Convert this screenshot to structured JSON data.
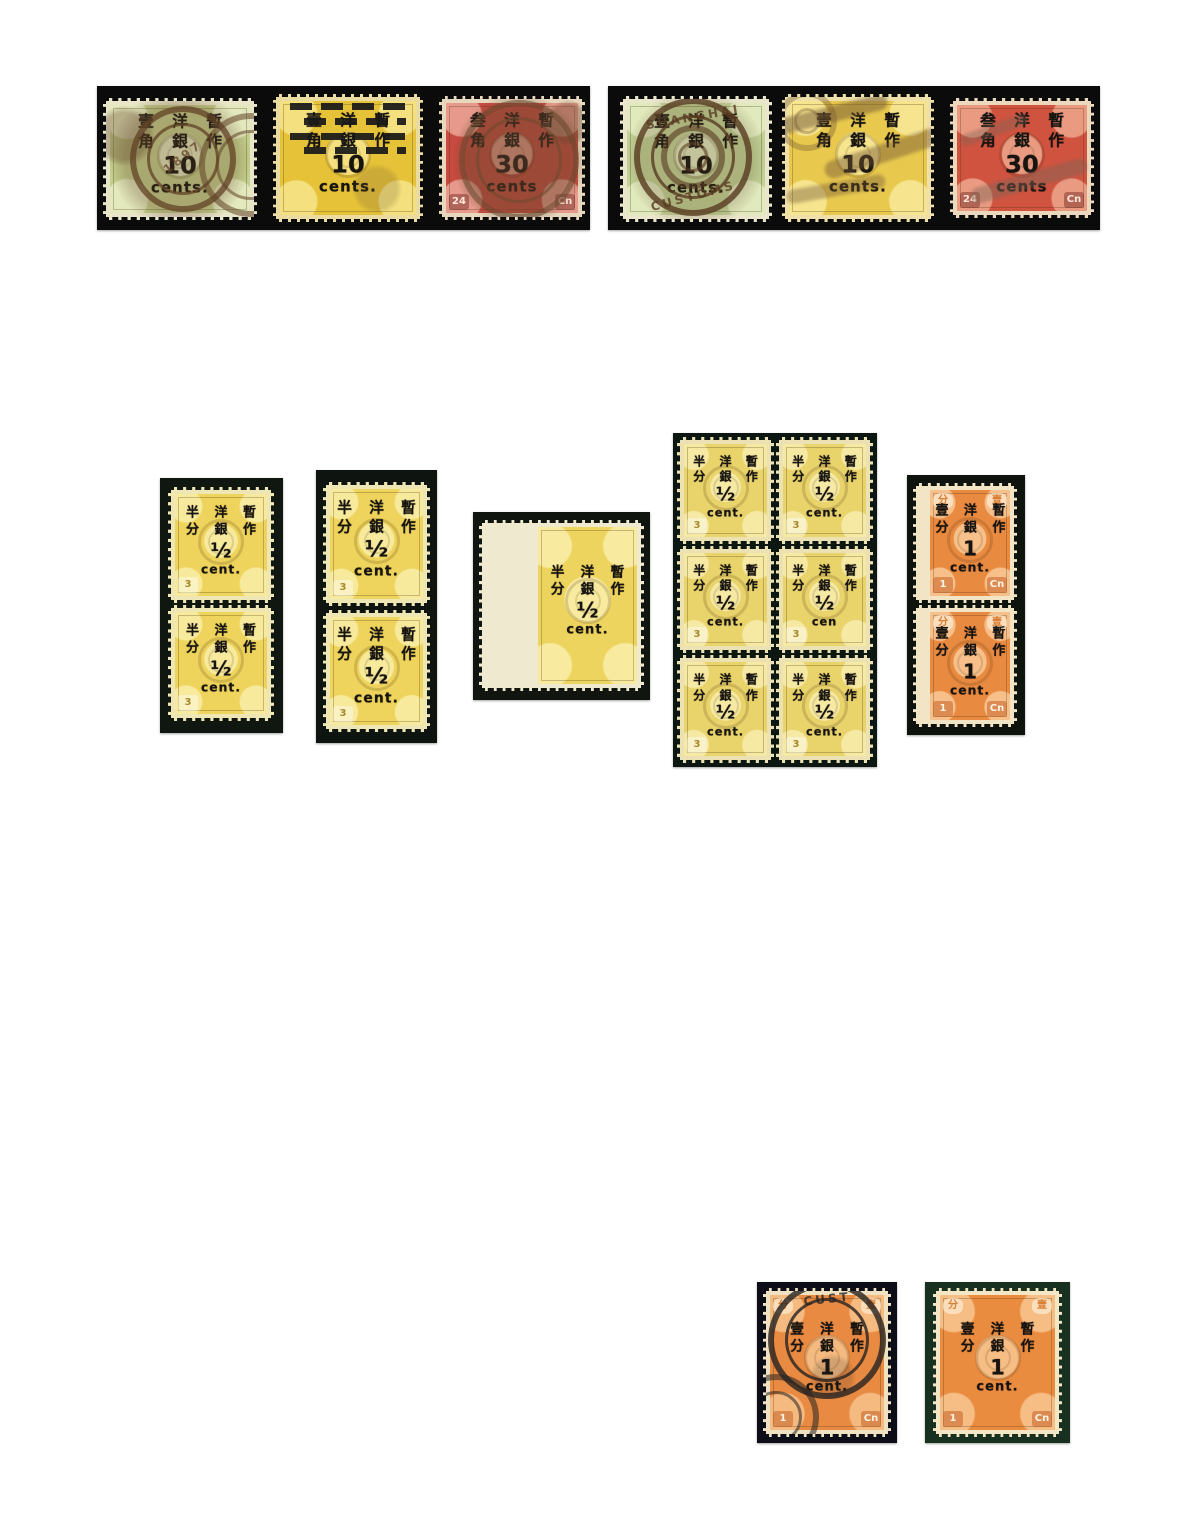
{
  "page": {
    "bg": "#ffffff",
    "width": 1194,
    "height": 1539
  },
  "stamp_groups": [
    {
      "name": "strip-left",
      "x": 97,
      "y": 86,
      "w": 493,
      "h": 144,
      "mat": "#0b0b0b",
      "stamps": [
        {
          "x": 6,
          "y": 12,
          "w": 154,
          "h": 122,
          "base": "#c3cf8c",
          "light": "#e3e9bd",
          "paper": "#e9e5c9",
          "op_scale": 1.2,
          "overprint": {
            "row1": "壹 洋 暫",
            "row2": "角 銀 作",
            "value": "10",
            "unit": "cents."
          },
          "cancels": [
            {
              "kind": "blob",
              "cx": 50,
              "cy": 50,
              "d": 140,
              "color": "rgba(97,66,38,0.28)"
            },
            {
              "kind": "ring",
              "cx": 52,
              "cy": 50,
              "d": 106,
              "color": "rgba(97,66,38,0.75)",
              "text": "1897",
              "rot": -38,
              "ty": "40%"
            },
            {
              "kind": "ring",
              "cx": 98,
              "cy": 55,
              "d": 104,
              "color": "rgba(97,66,38,0.55)"
            },
            {
              "kind": "blob",
              "cx": 12,
              "cy": 30,
              "d": 60,
              "color": "rgba(97,66,38,0.35)"
            }
          ]
        },
        {
          "x": 176,
          "y": 8,
          "w": 150,
          "h": 128,
          "base": "#e5c238",
          "light": "#f4e07e",
          "paper": "#eadca0",
          "op_scale": 1.2,
          "overprint": {
            "row1": "壹 洋 暫",
            "row2": "角 銀 作",
            "value": "10",
            "unit": "cents."
          },
          "cancels": [
            {
              "kind": "bars",
              "x": 10,
              "y": 5,
              "w": 80,
              "h": 42,
              "color": "rgba(24,24,24,0.92)"
            },
            {
              "kind": "blob",
              "cx": 70,
              "cy": 75,
              "d": 50,
              "color": "rgba(110,85,50,0.22)"
            }
          ]
        },
        {
          "x": 342,
          "y": 10,
          "w": 146,
          "h": 124,
          "base": "#c94a41",
          "light": "#e79a8b",
          "paper": "#e7d8bd",
          "op_scale": 1.2,
          "corners": {
            "bl": "24",
            "br": "Cn"
          },
          "badge": {
            "fg": "#ffe9da",
            "bg": "rgba(90,15,12,0.38)"
          },
          "overprint": {
            "row1": "叁 洋 暫",
            "row2": "角 銀 作",
            "value": "30",
            "unit": "cents"
          },
          "cancels": [
            {
              "kind": "blob",
              "cx": 55,
              "cy": 52,
              "d": 132,
              "color": "rgba(104,72,46,0.45)"
            },
            {
              "kind": "ring",
              "cx": 55,
              "cy": 52,
              "d": 120,
              "color": "rgba(104,72,46,0.55)"
            },
            {
              "kind": "blob",
              "cx": 90,
              "cy": 20,
              "d": 46,
              "color": "rgba(104,72,46,0.4)"
            }
          ]
        }
      ]
    },
    {
      "name": "strip-right",
      "x": 608,
      "y": 86,
      "w": 492,
      "h": 144,
      "mat": "#0b0b0b",
      "stamps": [
        {
          "x": 12,
          "y": 10,
          "w": 152,
          "h": 126,
          "base": "#c2d396",
          "light": "#e1eabd",
          "paper": "#e9e6cb",
          "op_scale": 1.2,
          "overprint": {
            "row1": "壹 洋 暫",
            "row2": "角 銀 作",
            "value": "10",
            "unit": "cents."
          },
          "cancels": [
            {
              "kind": "blob",
              "cx": 50,
              "cy": 50,
              "d": 140,
              "color": "rgba(88,59,33,0.22)"
            },
            {
              "kind": "ring",
              "cx": 48,
              "cy": 48,
              "d": 118,
              "color": "rgba(88,59,33,0.8)",
              "text": "SHANGHAI",
              "rot": -10,
              "ty": "6%",
              "text2": "CUSTOMS",
              "rot2": -15
            },
            {
              "kind": "ring",
              "cx": 48,
              "cy": 48,
              "d": 64,
              "color": "rgba(88,59,33,0.6)"
            }
          ]
        },
        {
          "x": 174,
          "y": 8,
          "w": 152,
          "h": 128,
          "base": "#e8c94e",
          "light": "#f6e48e",
          "paper": "#eee0a8",
          "op_scale": 1.2,
          "overprint": {
            "row1": "壹 洋 暫",
            "row2": "角 銀 作",
            "value": "10",
            "unit": "cents."
          },
          "cancels": [
            {
              "kind": "streak",
              "cx": 30,
              "cy": 15,
              "w": 120,
              "h": 16,
              "rot": -14,
              "color": "rgba(112,84,52,0.5)"
            },
            {
              "kind": "streak",
              "cx": 70,
              "cy": 45,
              "w": 130,
              "h": 18,
              "rot": -18,
              "color": "rgba(112,84,52,0.45)"
            },
            {
              "kind": "streak",
              "cx": 35,
              "cy": 75,
              "w": 100,
              "h": 14,
              "rot": -10,
              "color": "rgba(112,84,52,0.4)"
            },
            {
              "kind": "ring",
              "cx": 15,
              "cy": 20,
              "d": 60,
              "color": "rgba(112,84,52,0.35)"
            }
          ]
        },
        {
          "x": 342,
          "y": 12,
          "w": 144,
          "h": 120,
          "base": "#d05340",
          "light": "#eb9a82",
          "paper": "#ecd8bc",
          "op_scale": 1.2,
          "corners": {
            "bl": "24",
            "br": "Cn"
          },
          "badge": {
            "fg": "#ffe9da",
            "bg": "rgba(90,15,12,0.38)"
          },
          "overprint": {
            "row1": "叁 洋 暫",
            "row2": "角 銀 作",
            "value": "30",
            "unit": "cents"
          },
          "cancels": [
            {
              "kind": "streak",
              "cx": 55,
              "cy": 70,
              "w": 120,
              "h": 16,
              "rot": -16,
              "color": "rgba(125,100,85,0.45)"
            },
            {
              "kind": "streak",
              "cx": 30,
              "cy": 25,
              "w": 70,
              "h": 12,
              "rot": -20,
              "color": "rgba(125,100,85,0.4)"
            }
          ]
        }
      ]
    },
    {
      "name": "pair-yellow-left",
      "x": 160,
      "y": 478,
      "w": 123,
      "h": 255,
      "mat": "#101711",
      "stamps": [
        {
          "x": 8,
          "y": 9,
          "w": 106,
          "h": 116,
          "base": "#eed45c",
          "light": "#f8ea9d",
          "paper": "#efe6b6",
          "op_scale": 1.0,
          "corners": {
            "bl": "3"
          },
          "badge": {
            "fg": "#a8882a",
            "bg": "rgba(255,255,255,0.4)"
          },
          "overprint": {
            "row1": "半 洋 暫",
            "row2": "分 銀 作",
            "value": "½",
            "unit": "cent."
          }
        },
        {
          "x": 8,
          "y": 127,
          "w": 106,
          "h": 116,
          "base": "#eed45c",
          "light": "#f8ea9d",
          "paper": "#efe6b6",
          "op_scale": 1.0,
          "corners": {
            "bl": "3"
          },
          "badge": {
            "fg": "#a8882a",
            "bg": "rgba(255,255,255,0.4)"
          },
          "overprint": {
            "row1": "半 洋 暫",
            "row2": "分 銀 作",
            "value": "½",
            "unit": "cent."
          }
        }
      ]
    },
    {
      "name": "pair-yellow-mid",
      "x": 316,
      "y": 470,
      "w": 121,
      "h": 273,
      "mat": "#0e1511",
      "stamps": [
        {
          "x": 7,
          "y": 12,
          "w": 107,
          "h": 124,
          "base": "#eed45c",
          "light": "#f8ea9d",
          "paper": "#efe6b6",
          "op_scale": 1.12,
          "corners": {
            "bl": "3"
          },
          "badge": {
            "fg": "#a8882a",
            "bg": "rgba(255,255,255,0.4)"
          },
          "overprint": {
            "row1": "半 洋 暫",
            "row2": "分 銀 作",
            "value": "½",
            "unit": "cent."
          }
        },
        {
          "x": 7,
          "y": 140,
          "w": 107,
          "h": 122,
          "base": "#eed45c",
          "light": "#f8ea9d",
          "paper": "#efe6b6",
          "op_scale": 1.12,
          "corners": {
            "bl": "3"
          },
          "badge": {
            "fg": "#a8882a",
            "bg": "rgba(255,255,255,0.4)"
          },
          "overprint": {
            "row1": "半 洋 暫",
            "row2": "分 銀 作",
            "value": "½",
            "unit": "cent."
          }
        }
      ]
    },
    {
      "name": "single-yellow-margin",
      "x": 473,
      "y": 512,
      "w": 177,
      "h": 188,
      "mat": "#10160f",
      "stamps": [
        {
          "x": 6,
          "y": 8,
          "w": 165,
          "h": 171,
          "ml": 56,
          "base": "#edd45f",
          "light": "#f8eb9f",
          "paper": "#efe9cf",
          "op_scale": 1.05,
          "overprint": {
            "row1": "半 洋 暫",
            "row2": "分 銀 作",
            "value": "½",
            "unit": "cent."
          }
        }
      ]
    },
    {
      "name": "block-of-six-yellow",
      "x": 673,
      "y": 433,
      "w": 204,
      "h": 334,
      "mat": "#0d1712",
      "stamps": [
        {
          "x": 4,
          "y": 4,
          "w": 97,
          "h": 107,
          "base": "#e9d36b",
          "light": "#f6e9a4",
          "paper": "#ece1b2",
          "op_scale": 0.92,
          "corners": {
            "bl": "3"
          },
          "badge": {
            "fg": "#a8882a",
            "bg": "rgba(255,255,255,0.4)"
          },
          "overprint": {
            "row1": "半 洋 暫",
            "row2": "分 銀 作",
            "value": "½",
            "unit": "cent."
          }
        },
        {
          "x": 103,
          "y": 4,
          "w": 97,
          "h": 107,
          "base": "#e9d36b",
          "light": "#f6e9a4",
          "paper": "#ece1b2",
          "op_scale": 0.92,
          "corners": {
            "bl": "3"
          },
          "badge": {
            "fg": "#a8882a",
            "bg": "rgba(255,255,255,0.4)"
          },
          "overprint": {
            "row1": "半 洋 暫",
            "row2": "分 銀 作",
            "value": "½",
            "unit": "cent."
          }
        },
        {
          "x": 4,
          "y": 113,
          "w": 97,
          "h": 107,
          "base": "#e9d36b",
          "light": "#f6e9a4",
          "paper": "#ece1b2",
          "op_scale": 0.92,
          "corners": {
            "bl": "3"
          },
          "badge": {
            "fg": "#a8882a",
            "bg": "rgba(255,255,255,0.4)"
          },
          "overprint": {
            "row1": "半 洋 暫",
            "row2": "分 銀 作",
            "value": "½",
            "unit": "cent."
          }
        },
        {
          "x": 103,
          "y": 113,
          "w": 97,
          "h": 107,
          "base": "#e9d36b",
          "light": "#f6e9a4",
          "paper": "#ece1b2",
          "op_scale": 0.92,
          "corners": {
            "bl": "3"
          },
          "badge": {
            "fg": "#a8882a",
            "bg": "rgba(255,255,255,0.4)"
          },
          "overprint": {
            "row1": "半 洋 暫",
            "row2": "分 銀 作",
            "value": "½",
            "unit": "cen"
          }
        },
        {
          "x": 4,
          "y": 222,
          "w": 97,
          "h": 108,
          "base": "#e9d36b",
          "light": "#f6e9a4",
          "paper": "#ece1b2",
          "op_scale": 0.92,
          "corners": {
            "bl": "3"
          },
          "badge": {
            "fg": "#a8882a",
            "bg": "rgba(255,255,255,0.4)"
          },
          "overprint": {
            "row1": "半 洋 暫",
            "row2": "分 銀 作",
            "value": "½",
            "unit": "cent."
          }
        },
        {
          "x": 103,
          "y": 222,
          "w": 97,
          "h": 108,
          "base": "#e9d36b",
          "light": "#f6e9a4",
          "paper": "#ece1b2",
          "op_scale": 0.92,
          "corners": {
            "bl": "3"
          },
          "badge": {
            "fg": "#a8882a",
            "bg": "rgba(255,255,255,0.4)"
          },
          "overprint": {
            "row1": "半 洋 暫",
            "row2": "分 銀 作",
            "value": "½",
            "unit": "cent."
          }
        }
      ]
    },
    {
      "name": "pair-orange-margin",
      "x": 907,
      "y": 475,
      "w": 118,
      "h": 260,
      "mat": "#0e130d",
      "stamps": [
        {
          "x": 6,
          "y": 8,
          "w": 104,
          "h": 120,
          "ml": 14,
          "base": "#e98a41",
          "light": "#f7bf89",
          "paper": "#f2e5c6",
          "op_scale": 1.0,
          "corners": {
            "tl": "分",
            "tr": "壹",
            "bl": "1",
            "br": "Cn"
          },
          "badge": {
            "fg": "#fff3e4",
            "bg": "rgba(190,85,25,0.48)"
          },
          "badge_top": {
            "fg": "#d97f35",
            "bg": "rgba(255,245,225,0.6)"
          },
          "overprint": {
            "row1": "壹 洋 暫",
            "row2": "分 銀 作",
            "value": "1",
            "unit": "cent."
          }
        },
        {
          "x": 6,
          "y": 130,
          "w": 104,
          "h": 122,
          "ml": 14,
          "base": "#e98a41",
          "light": "#f7bf89",
          "paper": "#f2e5c6",
          "op_scale": 1.0,
          "corners": {
            "tl": "分",
            "tr": "壹",
            "bl": "1",
            "br": "Cn"
          },
          "badge": {
            "fg": "#fff3e4",
            "bg": "rgba(190,85,25,0.48)"
          },
          "badge_top": {
            "fg": "#d97f35",
            "bg": "rgba(255,245,225,0.6)"
          },
          "overprint": {
            "row1": "壹 洋 暫",
            "row2": "分 銀 作",
            "value": "1",
            "unit": "cent."
          }
        }
      ]
    },
    {
      "name": "single-orange-used",
      "x": 757,
      "y": 1282,
      "w": 140,
      "h": 161,
      "mat": "#0d0d18",
      "stamps": [
        {
          "x": 6,
          "y": 6,
          "w": 128,
          "h": 149,
          "base": "#e88a42",
          "light": "#f5ba80",
          "paper": "#efe2c2",
          "op_scale": 1.05,
          "corners": {
            "tl": "分",
            "tr": "壹",
            "bl": "1",
            "br": "Cn"
          },
          "badge": {
            "fg": "#fff3e4",
            "bg": "rgba(190,85,25,0.48)"
          },
          "badge_top": {
            "fg": "#d97f35",
            "bg": "rgba(255,245,225,0.6)"
          },
          "overprint": {
            "row1": "壹 洋 暫",
            "row2": "分 銀 作",
            "value": "1",
            "unit": "cent."
          },
          "cancels": [
            {
              "kind": "ring",
              "cx": 50,
              "cy": 34,
              "d": 118,
              "color": "rgba(38,34,32,0.8)",
              "text": "CUST",
              "rot": -6,
              "ty": "5%"
            },
            {
              "kind": "ring",
              "cx": 8,
              "cy": 88,
              "d": 86,
              "color": "rgba(38,34,32,0.55)"
            },
            {
              "kind": "blob",
              "cx": 55,
              "cy": 60,
              "d": 46,
              "color": "rgba(38,34,32,0.16)"
            }
          ]
        }
      ]
    },
    {
      "name": "single-orange-mint",
      "x": 925,
      "y": 1282,
      "w": 145,
      "h": 161,
      "mat": "#17301f",
      "stamps": [
        {
          "x": 8,
          "y": 6,
          "w": 129,
          "h": 149,
          "base": "#ea8c40",
          "light": "#f6bd84",
          "paper": "#f3e6c4",
          "op_scale": 1.05,
          "corners": {
            "tl": "分",
            "tr": "壹",
            "bl": "1",
            "br": "Cn"
          },
          "badge": {
            "fg": "#fff3e4",
            "bg": "rgba(190,85,25,0.48)"
          },
          "badge_top": {
            "fg": "#d97f35",
            "bg": "rgba(255,245,225,0.6)"
          },
          "overprint": {
            "row1": "壹 洋 暫",
            "row2": "分 銀 作",
            "value": "1",
            "unit": "cent."
          }
        }
      ]
    }
  ]
}
